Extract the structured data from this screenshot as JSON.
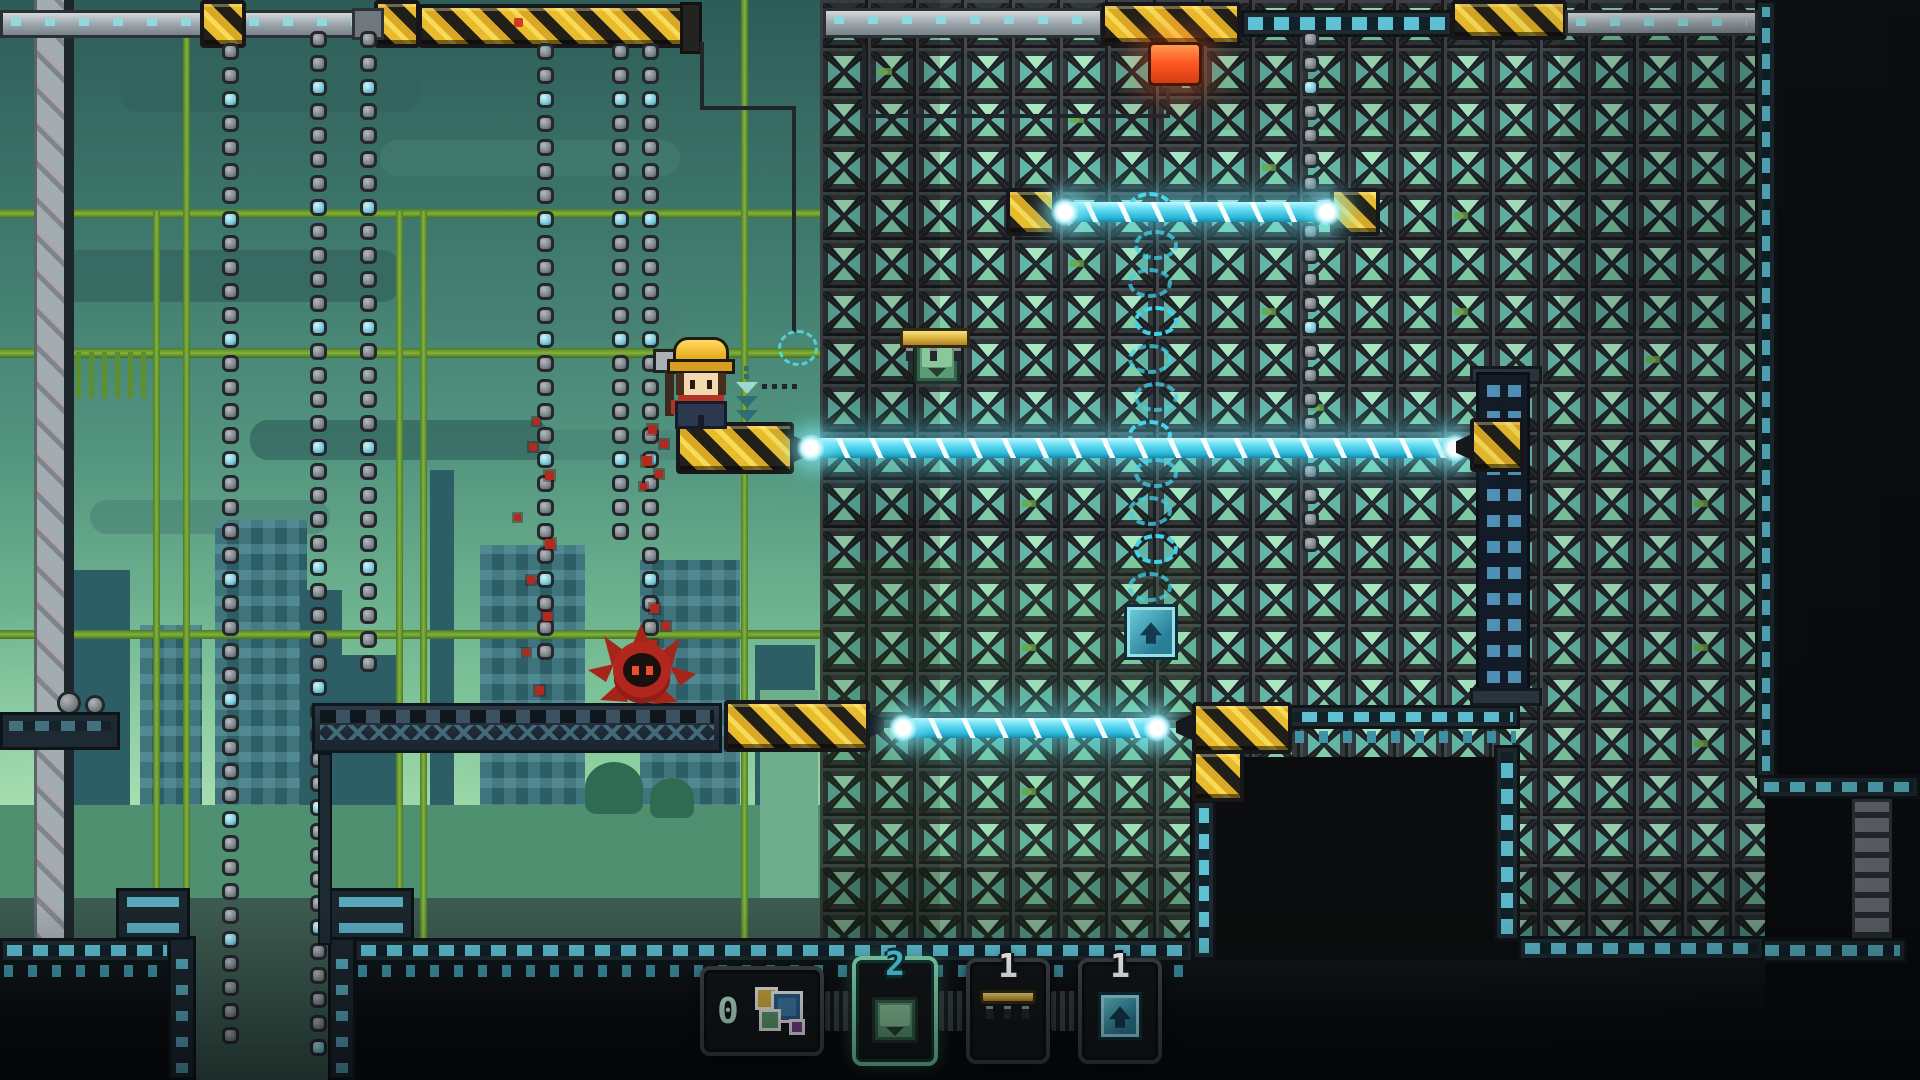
{
  "title": "pixel-platformer-level",
  "hud": {
    "hotbar": {
      "selected_slot_index": 1,
      "slots": [
        {
          "label": "0",
          "count": "",
          "icon": "layers-icon",
          "name": "blueprint-tool"
        },
        {
          "label": "",
          "count": "2",
          "icon": "crate-icon",
          "name": "crate-item"
        },
        {
          "label": "",
          "count": "1",
          "icon": "platform-icon",
          "name": "platform-item"
        },
        {
          "label": "",
          "count": "1",
          "icon": "jump-pad-icon",
          "name": "jump-pad-item"
        }
      ]
    }
  },
  "colors": {
    "laser": "#5fe2f6",
    "hazard_yellow": "#e8bc2d",
    "selection_mint": "#83dcb6",
    "count_cyan": "#4ed0e4",
    "count_white": "#ffffff",
    "enemy_red": "#b0271d",
    "wall_tile": "#34393c",
    "sky_top": "#2e5c58",
    "sky_bottom": "#d9f8cc"
  }
}
